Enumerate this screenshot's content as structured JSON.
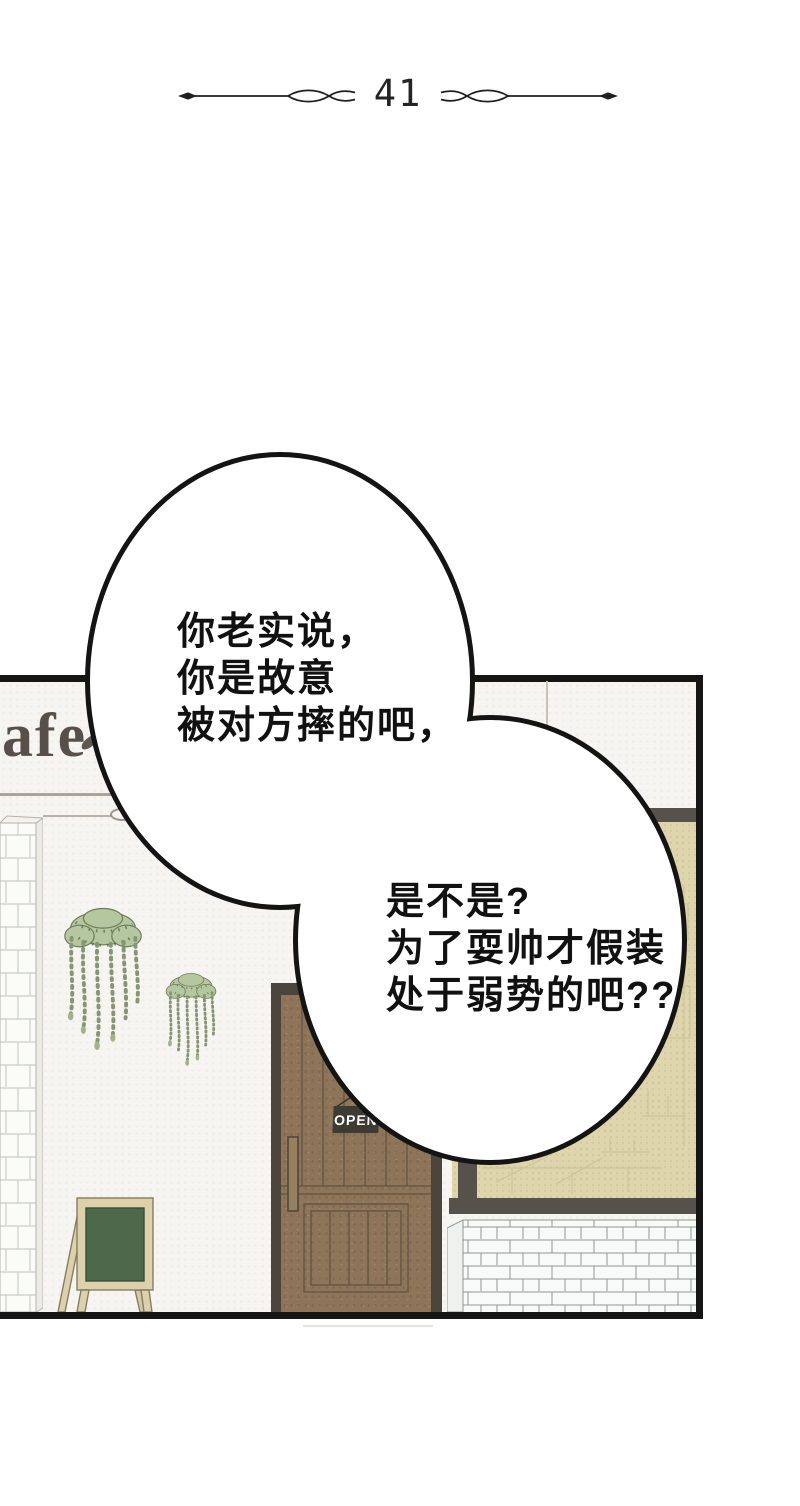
{
  "header": {
    "chapter_number": "41"
  },
  "speech": {
    "bubble1": [
      "你老实说，",
      "你是故意",
      "被对方摔的吧，"
    ],
    "bubble2": [
      "是不是?",
      "为了耍帅才假装",
      "处于弱势的吧??"
    ]
  },
  "storefront": {
    "sign_text": "afe",
    "open_sign_label": "OPEN",
    "colors": {
      "panel_border": "#151515",
      "wall": "#f6f5f1",
      "door_brown": "#8e7559",
      "door_frame": "#4b443c",
      "window_beige": "#ded5ad",
      "window_frame": "#56514a",
      "chalkboard_green": "#4e684b",
      "easel_wood": "#ddd1ab",
      "plant_green": "#b5c79e",
      "open_sign_bg": "#3e3b35",
      "open_sign_text": "#ffffff",
      "cafe_sign_text": "#57504a",
      "bubble_outline": "#141414",
      "brick_white": "#f8fafa"
    }
  }
}
